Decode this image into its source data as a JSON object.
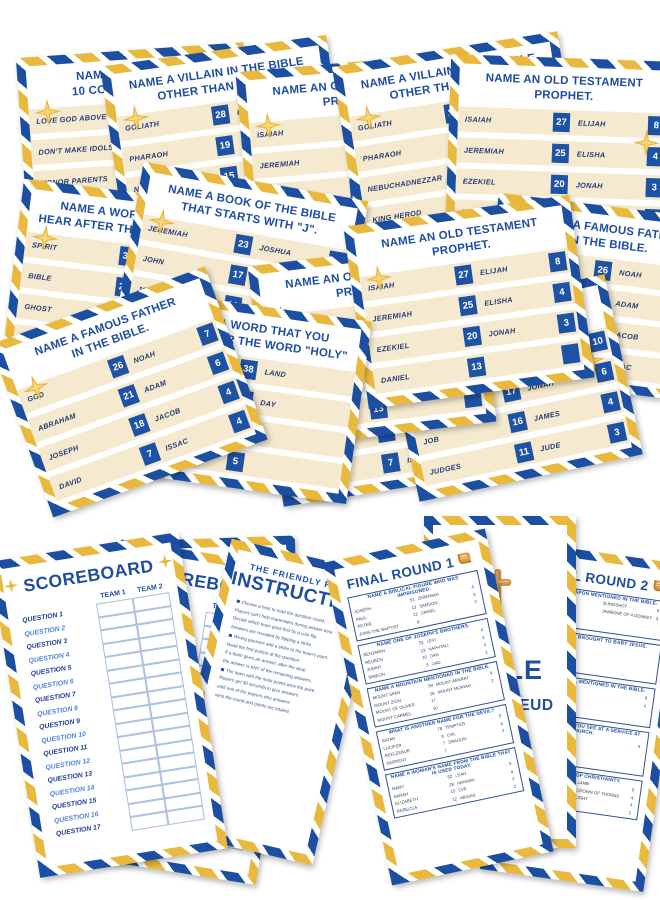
{
  "palette": {
    "navy": "#1c4fa1",
    "gold": "#e9b93d",
    "cream": "#f5ead0",
    "badge_blue": "#1d52a5",
    "title_blue": "#1d4ea0"
  },
  "cards": {
    "commandments": {
      "title": [
        "NAME ONE OF THE",
        "10 COMMANDMENTS"
      ],
      "rows": [
        [
          "LOVE GOD ABOVE ALL",
          "20",
          "DON'T LIE",
          null
        ],
        [
          "DON'T MAKE IDOLS",
          "16",
          "DON'T",
          null
        ],
        [
          "HONOR PARENTS",
          "15",
          "KEEP PROM",
          null
        ],
        [
          "DON'T KILL",
          "12",
          "DON'T",
          null
        ]
      ]
    },
    "villain": {
      "title": [
        "NAME A VILLAIN IN THE BIBLE",
        "OTHER THAN SATAN."
      ],
      "rows": [
        [
          "GOLIATH",
          "28",
          "PONTIUS PIL",
          null
        ],
        [
          "PHARAOH",
          "19",
          "JUDAS ISCA",
          null
        ],
        [
          "NEBUCHADNEZZAR",
          "15",
          "CAIN",
          null
        ],
        [
          "KING HEROD",
          "11",
          "",
          null
        ]
      ]
    },
    "prophet": {
      "title": [
        "NAME AN OLD TESTAMENT",
        "PROPHET."
      ],
      "rows": [
        [
          "ISAIAH",
          "27",
          "ELIJAH",
          "8"
        ],
        [
          "JEREMIAH",
          "25",
          "ELISHA",
          "4"
        ],
        [
          "EZEKIEL",
          "20",
          "JONAH",
          "3"
        ],
        [
          "DANIEL",
          "13",
          "",
          ""
        ]
      ]
    },
    "word_holy": {
      "title": [
        "NAME A WORD THAT YOU",
        "HEAR AFTER THE WORD \"HOLY\""
      ],
      "rows": [
        [
          "SPIRIT",
          "38",
          "LAND",
          null
        ],
        [
          "BIBLE",
          "29",
          "DAY",
          null
        ],
        [
          "GHOST",
          "17",
          "",
          null
        ],
        [
          "TRINITY",
          "5",
          "",
          null
        ]
      ]
    },
    "book_j": {
      "title": [
        "NAME A BOOK OF THE BIBLE",
        "THAT STARTS WITH \"J\"."
      ],
      "rows": [
        [
          "JEREMIAH",
          "23",
          "JOSHUA",
          "10"
        ],
        [
          "JOHN",
          "17",
          "JONAH",
          "6"
        ],
        [
          "JOB",
          "16",
          "JAMES",
          "4"
        ],
        [
          "JUDGES",
          "11",
          "JUDE",
          "3"
        ]
      ]
    },
    "father": {
      "title": [
        "NAME A FAMOUS FATHER",
        "IN THE BIBLE."
      ],
      "rows": [
        [
          "GOD",
          "26",
          "NOAH",
          "7"
        ],
        [
          "ABRAHAM",
          "21",
          "ADAM",
          "6"
        ],
        [
          "JOSEPH",
          "18",
          "JACOB",
          "4"
        ],
        [
          "DAVID",
          "7",
          "ISSAC",
          "4"
        ]
      ]
    }
  },
  "scoreboard": {
    "title": "SCOREBOARD",
    "teams": [
      "TEAM 1",
      "TEAM 2"
    ],
    "questions": [
      "QUESTION 1",
      "QUESTION 2",
      "QUESTION 3",
      "QUESTION 4",
      "QUESTION 5",
      "QUESTION 6",
      "QUESTION 7",
      "QUESTION 8",
      "QUESTION 9",
      "QUESTION 10",
      "QUESTION 11",
      "QUESTION 12",
      "QUESTION 13",
      "QUESTION 14",
      "QUESTION 15",
      "QUESTION 16",
      "QUESTION 17"
    ]
  },
  "instructions": {
    "heading": "THE FRIENDLY FEUD",
    "title": "INSTRUCTIONS",
    "lines": [
      "Choose a host to read the question round.",
      "Players can't help teammates during answer time.",
      "Decide which team goes first by a coin flip.",
      "Answers are revealed by flipping a strike.",
      "Wrong guesses add a strike to the team's point.",
      "Read the first portion of the question.",
      "If a team gives an answer, after the steal",
      "the answer is ANY of the remaining answers.",
      "The team with the most points wins the point.",
      "Players get 30 seconds to give answers",
      "until one of the players who answers",
      "wins the round and points are totaled."
    ]
  },
  "final_round_1": {
    "title": "FINAL ROUND 1",
    "sections": [
      {
        "q": "NAME A BIBLICAL FIGURE WHO WAS IMPRISONED.",
        "rows": [
          [
            "JOSEPH",
            "51",
            "JEREMIAH",
            "4"
          ],
          [
            "PAUL",
            "13",
            "SAMSON",
            "3"
          ],
          [
            "PETER",
            "12",
            "DANIEL",
            "2"
          ],
          [
            "JOHN THE BAPTIST",
            "9",
            "",
            ""
          ]
        ]
      },
      {
        "q": "NAME ONE OF JOSEPH'S BROTHERS.",
        "rows": [
          [
            "BENJAMIN",
            "52",
            "LEVI",
            "4"
          ],
          [
            "REUBEN",
            "23",
            "NAPHTALI",
            "3"
          ],
          [
            "JUDAH",
            "10",
            "DAN",
            "2"
          ],
          [
            "SIMEON",
            "5",
            "GAD",
            "2"
          ]
        ]
      },
      {
        "q": "NAME A MOUNTAIN MENTIONED IN THE BIBLE.",
        "rows": [
          [
            "MOUNT SINAI",
            "59",
            "MOUNT ARARAT",
            "4"
          ],
          [
            "MOUNT ZION",
            "28",
            "MOUNT MORIAH",
            "2"
          ],
          [
            "MOUNT OF OLIVES",
            "17",
            "",
            ""
          ],
          [
            "MOUNT CARMEL",
            "10",
            "",
            ""
          ]
        ]
      },
      {
        "q": "WHAT IS ANOTHER NAME FOR THE DEVIL?",
        "rows": [
          [
            "SATAN",
            "78",
            "TEMPTER",
            "5"
          ],
          [
            "LUCIFER",
            "9",
            "EVIL",
            "4"
          ],
          [
            "BEELZEBUB",
            "7",
            "DRAGON",
            "2"
          ],
          [
            "SERPENT",
            "7",
            "",
            ""
          ]
        ]
      },
      {
        "q": "NAME A WOMAN'S NAME FROM THE BIBLE THAT IS USED TODAY.",
        "rows": [
          [
            "MARY",
            "52",
            "LEAH",
            "5"
          ],
          [
            "SARAH",
            "28",
            "HANNAH",
            "4"
          ],
          [
            "ELIZABETH",
            "15",
            "EVE",
            "2"
          ],
          [
            "REBECCA",
            "12",
            "ABIGAIL",
            "2"
          ]
        ]
      }
    ]
  },
  "final_round_2": {
    "title": "FINAL ROUND 2",
    "sections": [
      {
        "q": "NAME A WEAPON MENTIONED IN THE BIBLE.",
        "rows": [
          [
            "",
            "",
            "SLINGSHOT",
            "5"
          ],
          [
            "",
            "",
            "JAWBONE OF A DONKEY",
            "3"
          ],
          [
            "",
            "",
            "",
            ""
          ],
          [
            "",
            "",
            "",
            ""
          ]
        ]
      },
      {
        "q": "NAME A GIFT BROUGHT TO BABY JESUS.",
        "rows": [
          [
            "",
            "",
            "",
            ""
          ],
          [
            "",
            "",
            "",
            ""
          ],
          [
            "",
            "",
            "",
            ""
          ],
          [
            "",
            "",
            "",
            ""
          ]
        ]
      },
      {
        "q": "NAME AN ANIMAL MENTIONED IN THE BIBLE.",
        "rows": [
          [
            "",
            "",
            "",
            "9"
          ],
          [
            "",
            "",
            "",
            "4"
          ],
          [
            "",
            "",
            "",
            ""
          ],
          [
            "",
            "",
            "",
            ""
          ]
        ]
      },
      {
        "q": "NAME SOMETHING YOU SEE AT A SERVICE AT CHURCH.",
        "rows": [
          [
            "",
            "",
            "",
            "5"
          ],
          [
            "",
            "",
            "",
            ""
          ],
          [
            "",
            "",
            "",
            ""
          ],
          [
            "",
            "",
            "",
            ""
          ]
        ]
      },
      {
        "q": "NAME A SYMBOL OF CHRISTIANITY.",
        "rows": [
          [
            "",
            "33",
            "LAMB",
            "5"
          ],
          [
            "",
            "12",
            "CROWN OF THORNS",
            "4"
          ],
          [
            "",
            "9",
            "LIGHT",
            "4"
          ],
          [
            "",
            "",
            "",
            "2"
          ]
        ]
      }
    ]
  },
  "bible_card": {
    "title_top": "BIBLE",
    "title_bottom": "FAMILY FEUD"
  }
}
